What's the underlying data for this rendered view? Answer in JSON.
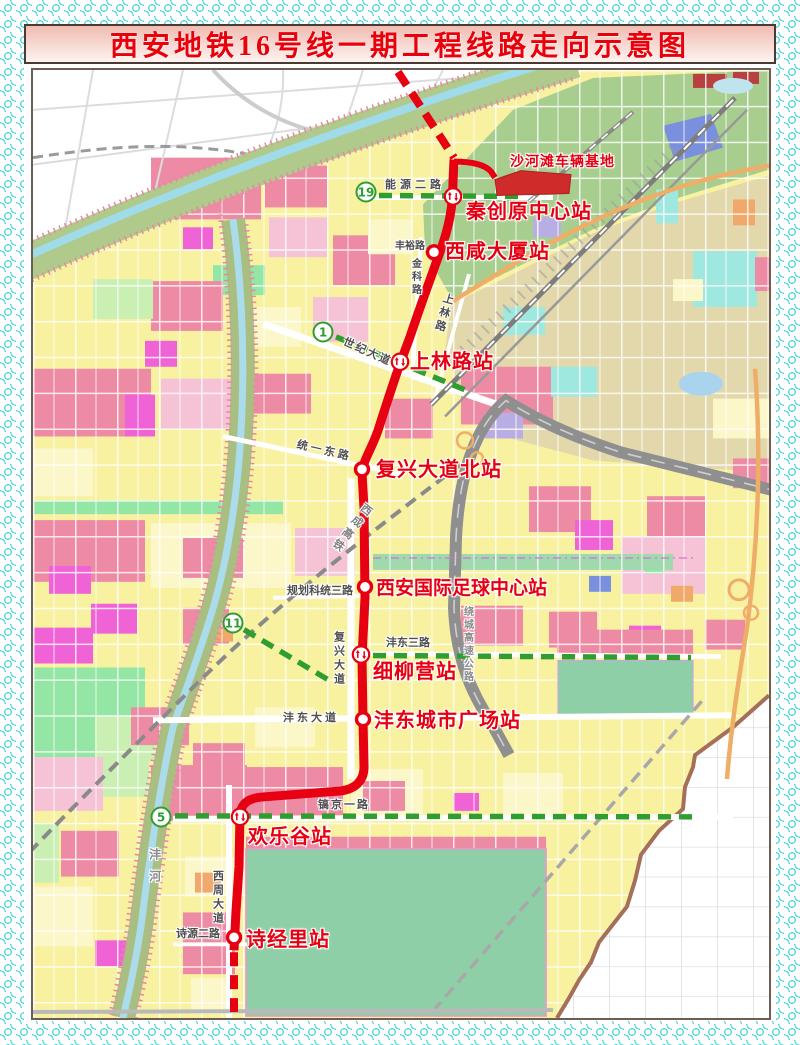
{
  "title": "西安地铁16号线一期工程线路走向示意图",
  "line16": {
    "name": "地铁16号线一期",
    "color": "#e60012",
    "depot_label": "沙河滩车辆基地",
    "stations": [
      {
        "name": "秦创原中心站",
        "transfer": true
      },
      {
        "name": "西咸大厦站",
        "transfer": false
      },
      {
        "name": "上林路站",
        "transfer": true
      },
      {
        "name": "复兴大道北站",
        "transfer": false
      },
      {
        "name": "西安国际足球中心站",
        "transfer": false
      },
      {
        "name": "细柳营站",
        "transfer": true
      },
      {
        "name": "沣东城市广场站",
        "transfer": false
      },
      {
        "name": "欢乐谷站",
        "transfer": true
      },
      {
        "name": "诗经里站",
        "transfer": false
      }
    ]
  },
  "other_lines": {
    "color": "#2f9e2f",
    "badges": [
      {
        "number": "19"
      },
      {
        "number": "1"
      },
      {
        "number": "11"
      },
      {
        "number": "5"
      }
    ]
  },
  "roads": {
    "nengyuan_erlu": "能源二路",
    "fengyu_lu": "丰裕路",
    "jinke_lu": "金科路",
    "shanglin_lu": "上林路",
    "shiji_dadao": "世纪大道",
    "tongyi_donglu": "统一东路",
    "guihua_ketong_sanlu": "规划科统三路",
    "fuxing_dadao": "复兴大道",
    "fengdong_sanlu": "沣东三路",
    "fengdong_dadao": "沣东大道",
    "haojing_yilu": "镐京一路",
    "xizhou_dadao": "西周大道",
    "shiyuan_erlu": "诗源二路"
  },
  "railway_label": "西成高铁",
  "highway_label": "绕城高速公路",
  "river_label": "沣河"
}
